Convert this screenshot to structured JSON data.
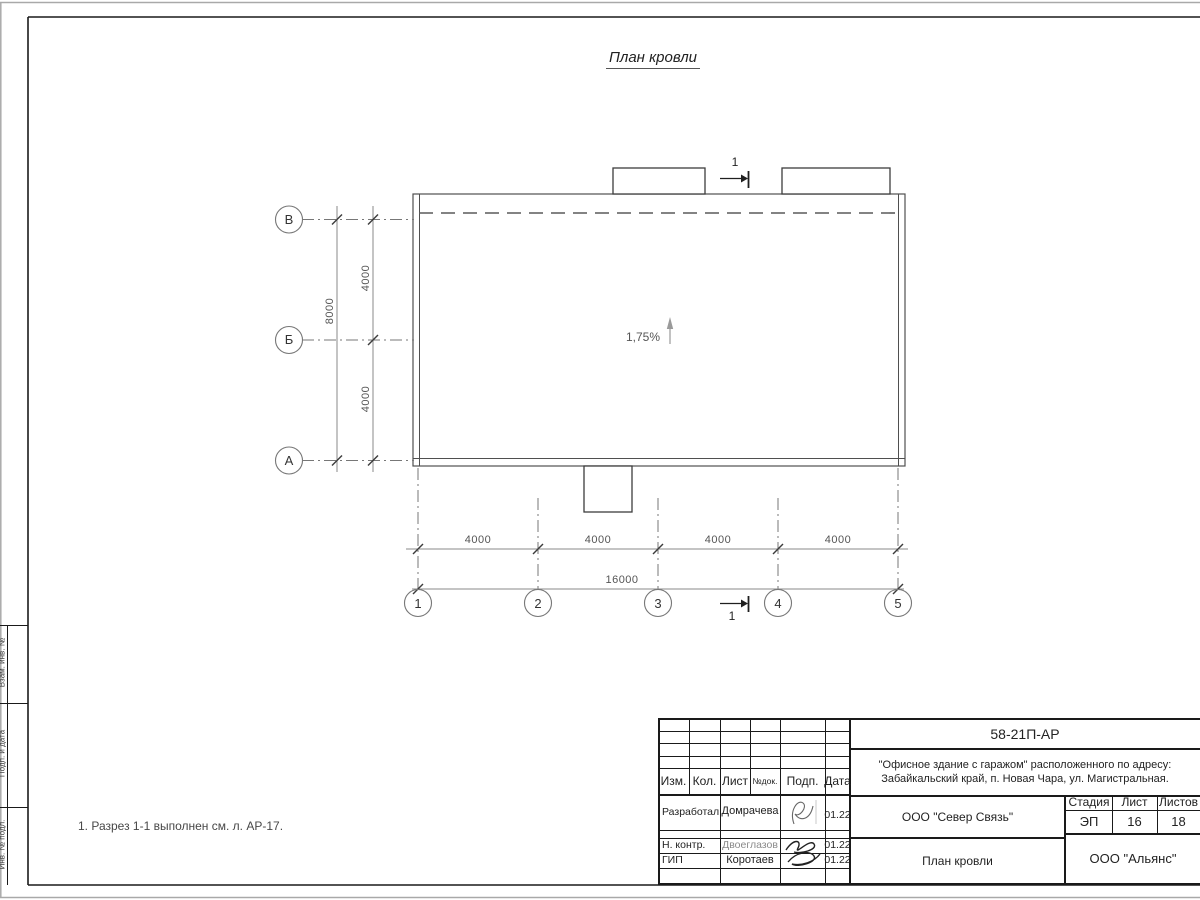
{
  "drawing": {
    "title": "План кровли",
    "slope_label": "1,75%",
    "section_top_label": "1",
    "section_bottom_label": "1",
    "note": "1. Разрез 1-1 выполнен см. л. АР-17."
  },
  "axes": {
    "horizontal": [
      "В",
      "Б",
      "А"
    ],
    "vertical": [
      "1",
      "2",
      "3",
      "4",
      "5"
    ]
  },
  "dimensions": {
    "left_segments": [
      "4000",
      "4000"
    ],
    "left_total": "8000",
    "bottom_segments": [
      "4000",
      "4000",
      "4000",
      "4000"
    ],
    "bottom_total": "16000"
  },
  "side_stamp": {
    "cells": [
      "Взам. инв. №",
      "Подп. и дата",
      "Инв. № подл."
    ]
  },
  "title_block": {
    "doc_number": "58-21П-АР",
    "project_line1": "\"Офисное здание с гаражом\" расположенного по адресу:",
    "project_line2": "Забайкальский край, п. Новая Чара, ул. Магистральная.",
    "columns": {
      "izm": "Изм.",
      "kol": "Кол.",
      "list": "Лист",
      "ndok": "№док.",
      "podp": "Подп.",
      "data": "Дата"
    },
    "rows": [
      {
        "role": "Разработал",
        "name": "Домрачева",
        "date": "01.22"
      },
      {
        "role": "Н. контр.",
        "name": "Двоеглазов",
        "date": "01.22"
      },
      {
        "role": "ГИП",
        "name": "Коротаев",
        "date": "01.22"
      }
    ],
    "org": "ООО \"Север Связь\"",
    "sheet_title": "План кровли",
    "company": "ООО \"Альянс\"",
    "stage_label": "Стадия",
    "sheet_label": "Лист",
    "sheets_label": "Листов",
    "stage_value": "ЭП",
    "sheet_value": "16",
    "sheets_value": "18"
  }
}
